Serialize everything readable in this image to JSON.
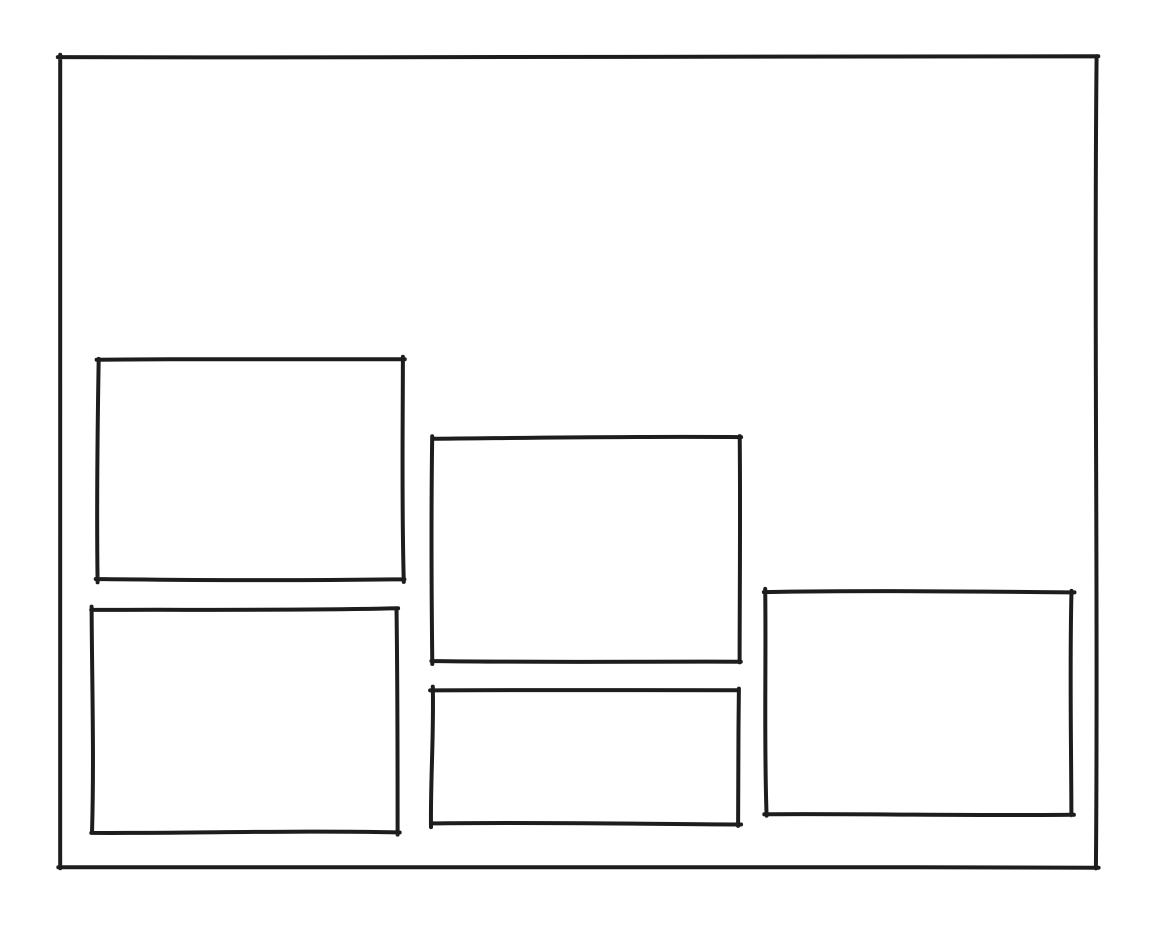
{
  "page": {
    "type": "hand-drawn-wireframe-sketch",
    "background": "#ffffff"
  },
  "sketch": {
    "stroke_color": "#1d1d1d",
    "stroke_width": 4,
    "canvas": {
      "width": 1150,
      "height": 942
    },
    "shapes": [
      {
        "name": "outer-frame",
        "x": 60,
        "y": 57,
        "width": 1036,
        "height": 811
      },
      {
        "name": "panel-top-left",
        "x": 98,
        "y": 360,
        "width": 305,
        "height": 220
      },
      {
        "name": "panel-middle-center",
        "x": 433,
        "y": 438,
        "width": 306,
        "height": 223
      },
      {
        "name": "panel-bottom-left",
        "x": 92,
        "y": 609,
        "width": 305,
        "height": 223
      },
      {
        "name": "panel-bottom-center",
        "x": 432,
        "y": 690,
        "width": 306,
        "height": 134
      },
      {
        "name": "panel-right",
        "x": 766,
        "y": 592,
        "width": 306,
        "height": 223
      }
    ]
  }
}
